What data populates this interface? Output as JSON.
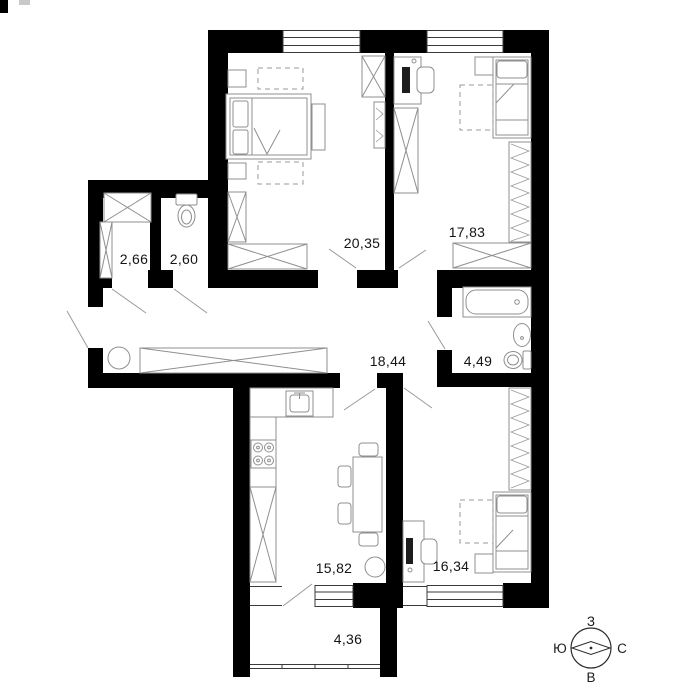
{
  "floor_plan": {
    "rooms": [
      {
        "key": "closet",
        "area": "2,66"
      },
      {
        "key": "wc",
        "area": "2,60"
      },
      {
        "key": "bedroom-1",
        "area": "20,35"
      },
      {
        "key": "bedroom-2",
        "area": "17,83"
      },
      {
        "key": "hallway",
        "area": "18,44"
      },
      {
        "key": "bathroom",
        "area": "4,49"
      },
      {
        "key": "kitchen",
        "area": "15,82"
      },
      {
        "key": "bedroom-3",
        "area": "16,34"
      },
      {
        "key": "balcony",
        "area": "4,36"
      }
    ],
    "compass": {
      "west": "З",
      "south": "Ю",
      "north": "С",
      "east": "В"
    },
    "colors": {
      "wall": "#000000",
      "furniture": "#8f8f8f",
      "label": "#141414",
      "background": "#ffffff"
    }
  }
}
